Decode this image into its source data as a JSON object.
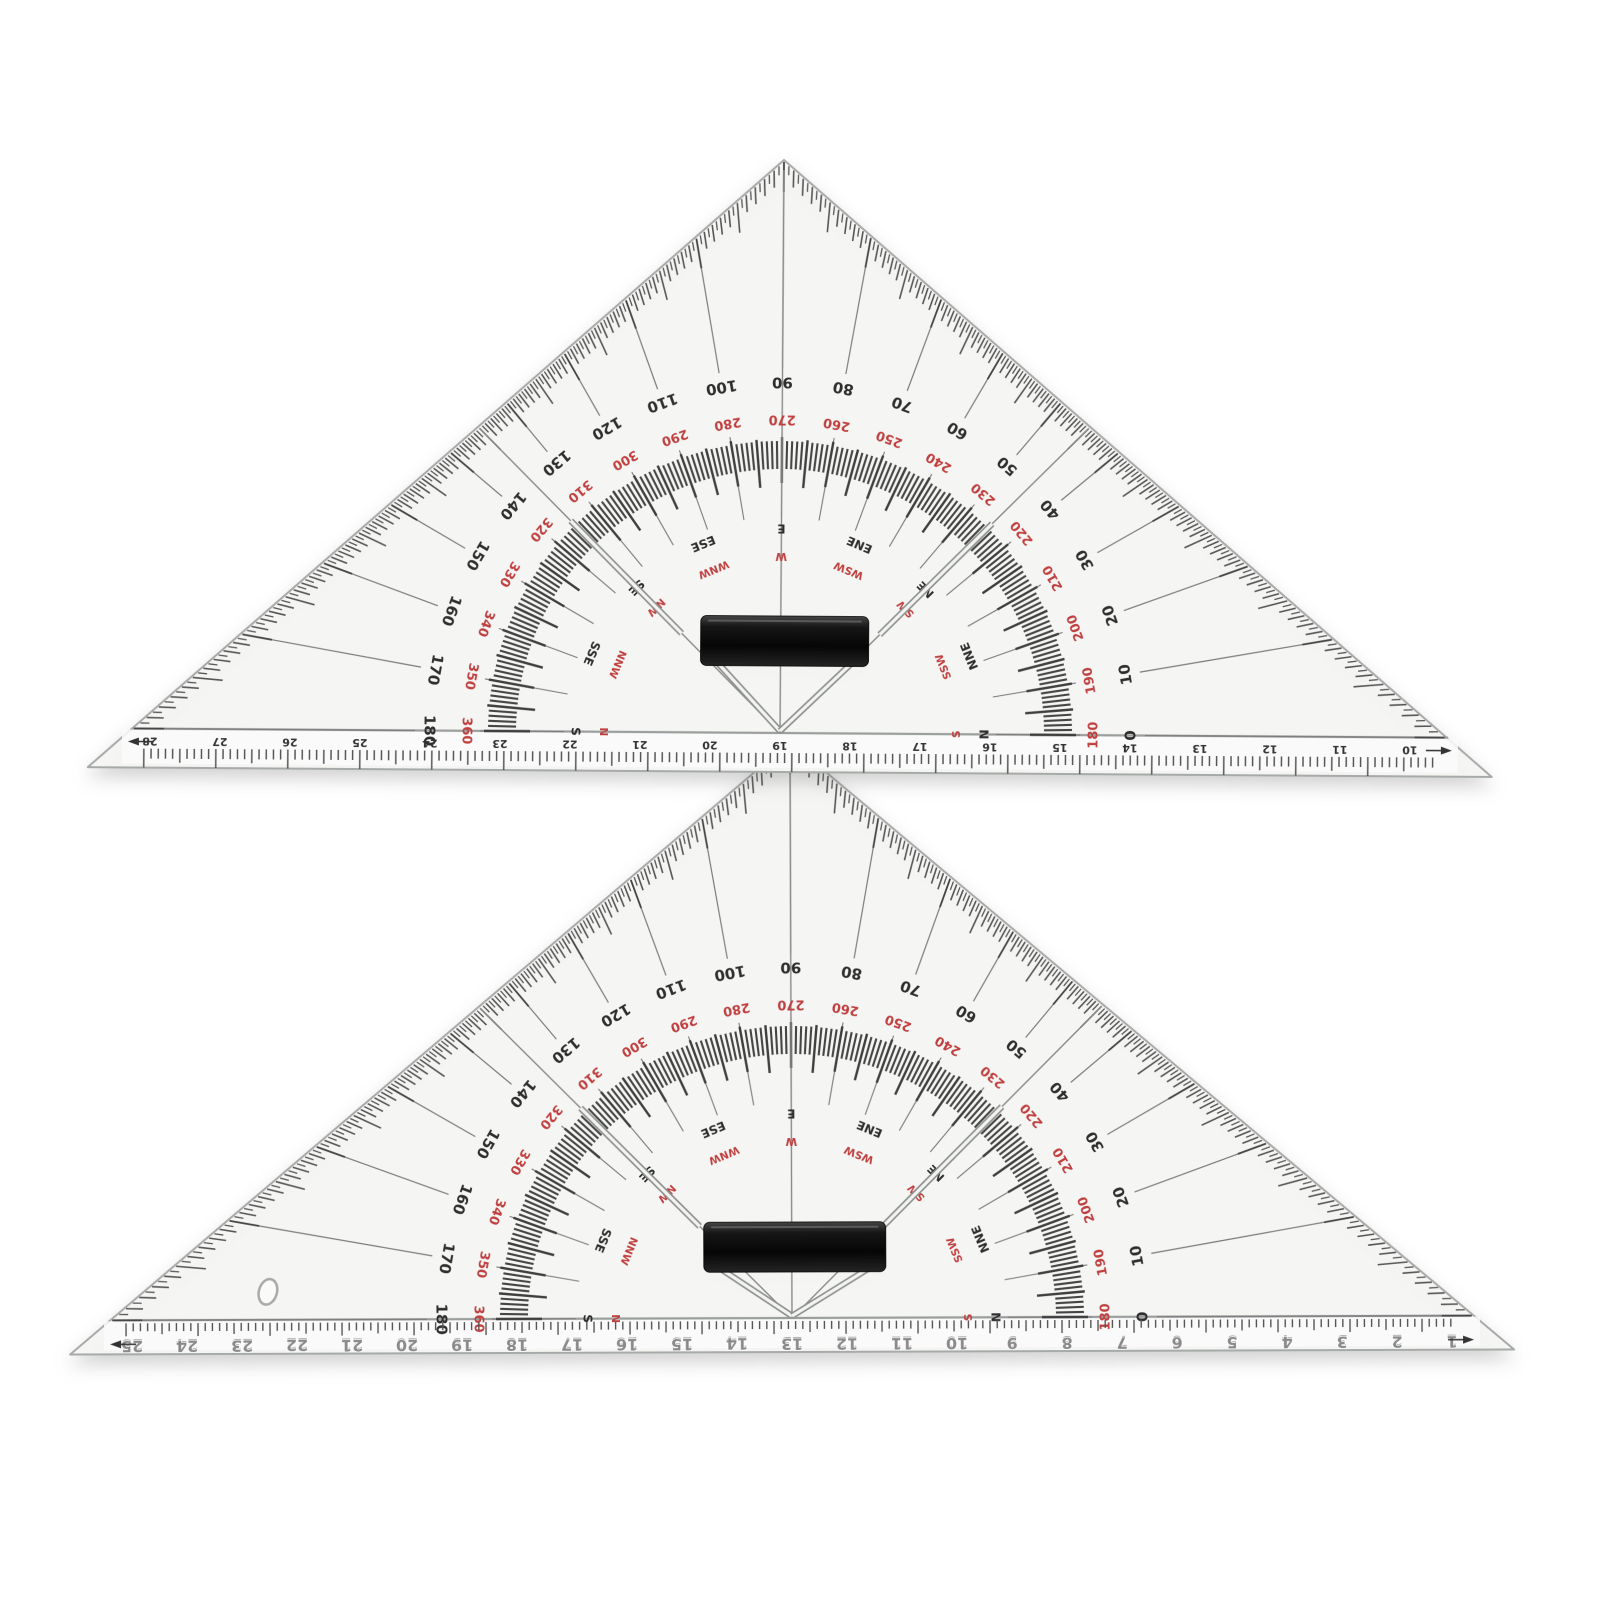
{
  "scene": {
    "background": "#ffffff"
  },
  "colors": {
    "plastic": "#f6f6f4",
    "ruler_strip": "#fcfcfb",
    "edge": "#a6aaa8",
    "black_text": "#2e2e2e",
    "red_text": "#c04040",
    "tick": "#4c4c4c",
    "ray": "#7c7c7c",
    "baseline": "#9a9e9c",
    "handle_dark": "#0a0a0a",
    "stand_core": "#f3f3f1",
    "stand_edge": "#8f938f",
    "emboss_fill": "#8a8a8a",
    "emboss_shadow": "#2e2e2e"
  },
  "protractor": {
    "degrees_black": [
      "0",
      "10",
      "20",
      "30",
      "40",
      "50",
      "60",
      "70",
      "80",
      "90",
      "100",
      "110",
      "120",
      "130",
      "140",
      "150",
      "160",
      "170",
      "180"
    ],
    "degrees_red": [
      "180",
      "190",
      "200",
      "210",
      "220",
      "230",
      "240",
      "250",
      "260",
      "270",
      "280",
      "290",
      "300",
      "310",
      "320",
      "330",
      "340",
      "350",
      "360"
    ],
    "compass_black": [
      "N",
      "NNE",
      "NE",
      "ENE",
      "E",
      "ESE",
      "SE",
      "SSE",
      "S"
    ],
    "compass_red": [
      "S",
      "SSW",
      "SW",
      "WSW",
      "W",
      "WNW",
      "NW",
      "NNW",
      "N"
    ]
  },
  "triangle_top": {
    "ruler_numbers": [
      "28",
      "27",
      "26",
      "25",
      "24",
      "23",
      "22",
      "21",
      "20",
      "19",
      "18",
      "17",
      "16",
      "15",
      "14",
      "13",
      "12",
      "11",
      "10"
    ]
  },
  "triangle_bottom": {
    "ruler_numbers": [
      "25",
      "24",
      "23",
      "22",
      "21",
      "20",
      "19",
      "18",
      "17",
      "16",
      "15",
      "14",
      "13",
      "12",
      "11",
      "10",
      "9",
      "8",
      "7",
      "6",
      "5",
      "4",
      "3",
      "2",
      "1"
    ]
  }
}
